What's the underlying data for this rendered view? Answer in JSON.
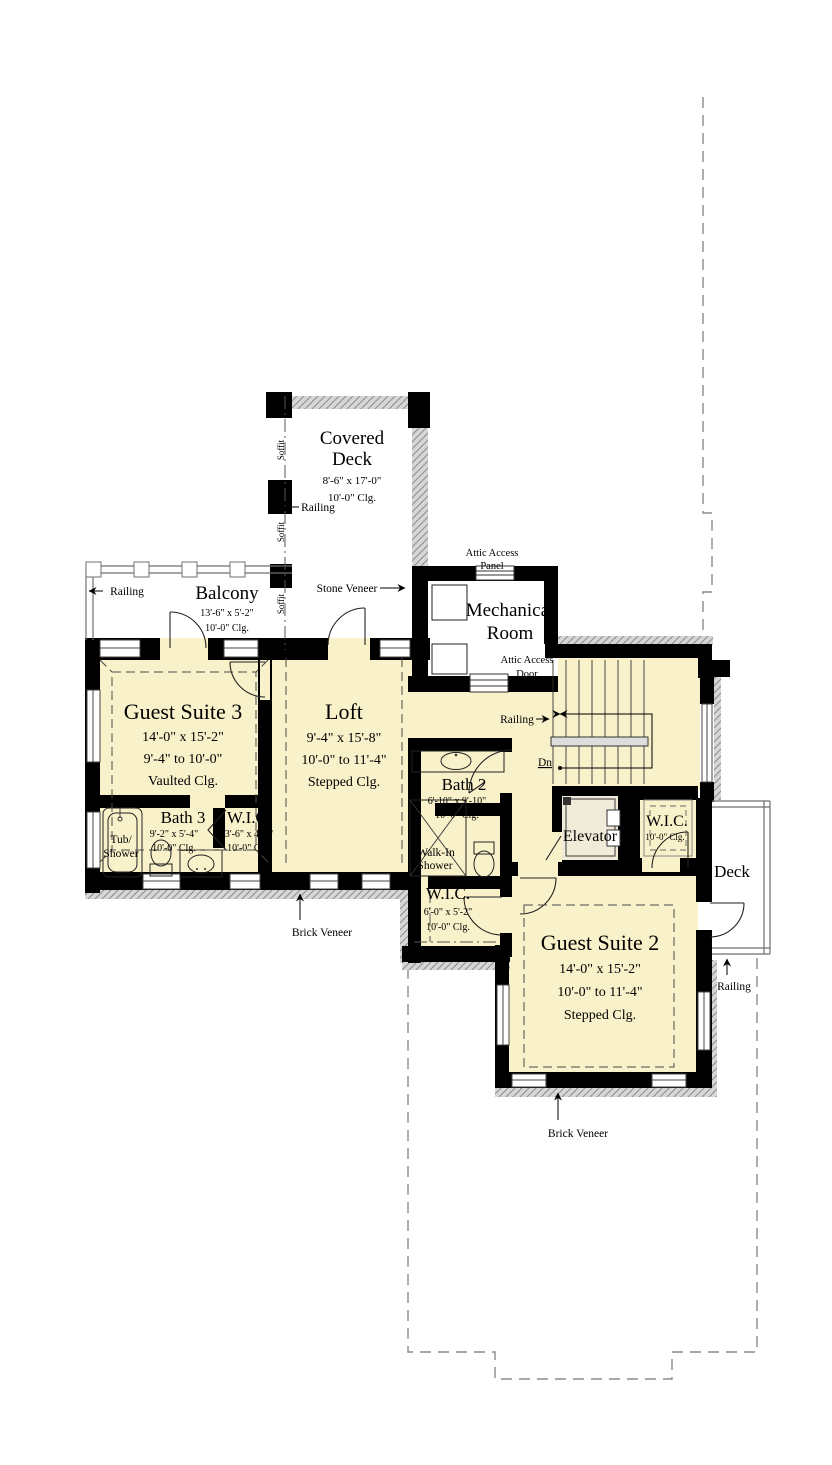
{
  "rooms": {
    "covered_deck": {
      "name1": "Covered",
      "name2": "Deck",
      "dims": "8'-6\" x 17'-0\"",
      "clg": "10'-0\" Clg."
    },
    "balcony": {
      "name": "Balcony",
      "dims": "13'-6\" x 5'-2\"",
      "clg": "10'-0\" Clg."
    },
    "mech": {
      "name1": "Mechanical",
      "name2": "Room"
    },
    "guest3": {
      "name": "Guest Suite 3",
      "dims": "14'-0\" x 15'-2\"",
      "ht": "9'-4\" to 10'-0\"",
      "clg": "Vaulted Clg."
    },
    "loft": {
      "name": "Loft",
      "dims": "9'-4\" x 15'-8\"",
      "ht": "10'-0\" to 11'-4\"",
      "clg": "Stepped Clg."
    },
    "bath2": {
      "name": "Bath 2",
      "dims": "6'-10\" x 9'-10\"",
      "clg": "10'-0\" Clg."
    },
    "bath3": {
      "name": "Bath 3",
      "dims": "9'-2\" x 5'-4\"",
      "clg": "10'-0\" Clg."
    },
    "wic3": {
      "name": "W.I.C.",
      "dims": "3'-6\" x 4'-4\"",
      "clg": "10'-0\" Clg."
    },
    "wic2": {
      "name": "W.I.C.",
      "dims": "6'-0\" x 5'-2\"",
      "clg": "10'-0\" Clg."
    },
    "wic_right": {
      "name": "W.I.C.",
      "clg": "10'-0\" Clg."
    },
    "elevator": {
      "name": "Elevator"
    },
    "guest2": {
      "name": "Guest Suite 2",
      "dims": "14'-0\" x 15'-2\"",
      "ht": "10'-0\" to 11'-4\"",
      "clg": "Stepped Clg."
    },
    "deck": {
      "name": "Deck"
    },
    "walkin_shower": {
      "name1": "Walk-In",
      "name2": "Shower"
    },
    "tub_shower": {
      "name1": "Tub/",
      "name2": "Shower"
    }
  },
  "annotations": {
    "railing": "Railing",
    "soffit": "Soffit",
    "stone_veneer": "Stone Veneer",
    "brick_veneer": "Brick Veneer",
    "attic_access": "Attic Access",
    "panel": "Panel",
    "door": "Door",
    "dn": "Dn"
  },
  "colors": {
    "floor": "#f8f1c9",
    "wall": "#000000",
    "veneer_gray": "#d2d2d2",
    "outline_gray": "#8c8c8c"
  }
}
